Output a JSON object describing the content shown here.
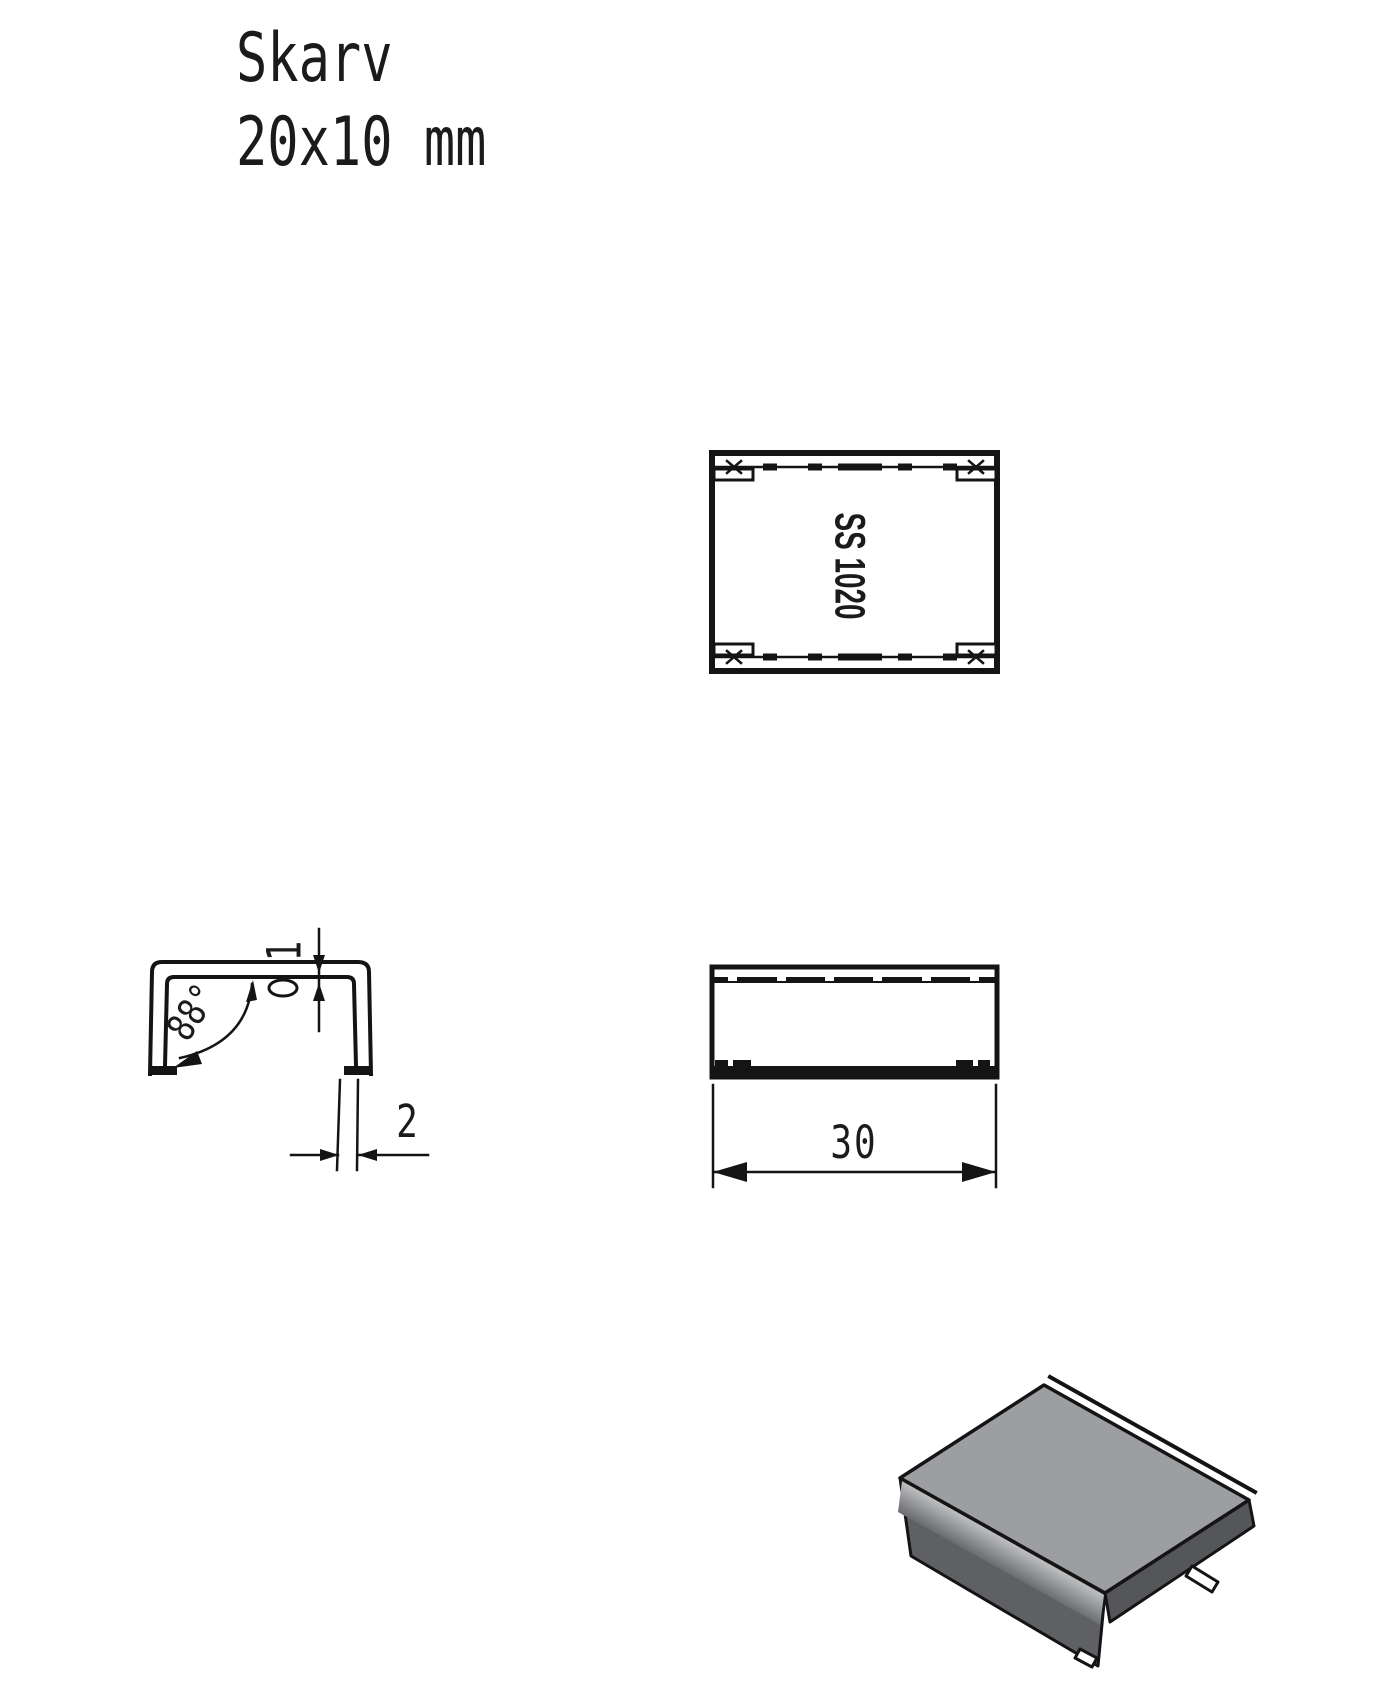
{
  "drawing": {
    "title_line1": "Skarv",
    "title_line2": "20x10 mm",
    "part_label": "SS 1020",
    "dims": {
      "angle": "88°",
      "wall_thickness": "1",
      "leg_thickness": "2",
      "length": "30"
    },
    "colors": {
      "line": "#141414",
      "top_face": "#9c9ea1",
      "front_face": "#5e6063",
      "side_face": "#54565a",
      "bend_highlight": "#c2c4c6"
    }
  }
}
